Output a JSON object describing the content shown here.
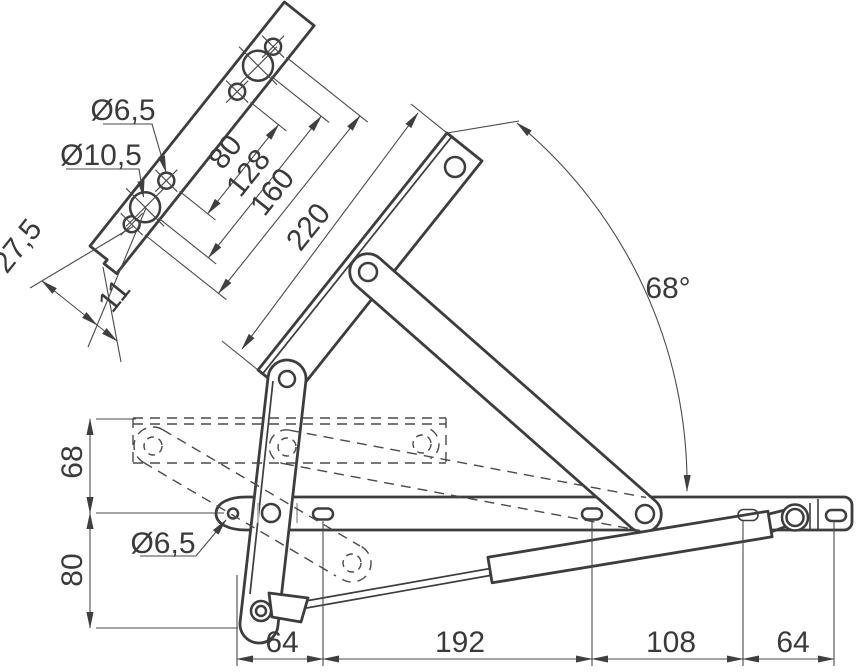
{
  "drawing": {
    "type": "technical-drawing",
    "subject": "lid stay / lift-up flap hinge mechanism with gas strut, open 68 degrees, closed position dashed",
    "units": "mm"
  },
  "labels": {
    "dia_top_small": "Ø6,5",
    "dia_top_big": "Ø10,5",
    "plate_pitch_inner": "80",
    "plate_pitch_mid": "128",
    "plate_pitch_outer": "160",
    "lid_rail_length": "220",
    "plate_end_width": "27,5",
    "plate_end_offset": "11",
    "opening_angle": "68°",
    "height_upper": "68",
    "height_lower": "80",
    "dia_base_hole": "Ø6,5",
    "base_seg_1": "64",
    "base_seg_2": "192",
    "base_seg_3": "108",
    "base_seg_4": "64"
  },
  "colors": {
    "background": "#ffffff",
    "outline": "#3d3d3d",
    "thin_line": "#4a4a4a",
    "text": "#3a3a3a",
    "gray_tick": "#b5b5b5"
  }
}
